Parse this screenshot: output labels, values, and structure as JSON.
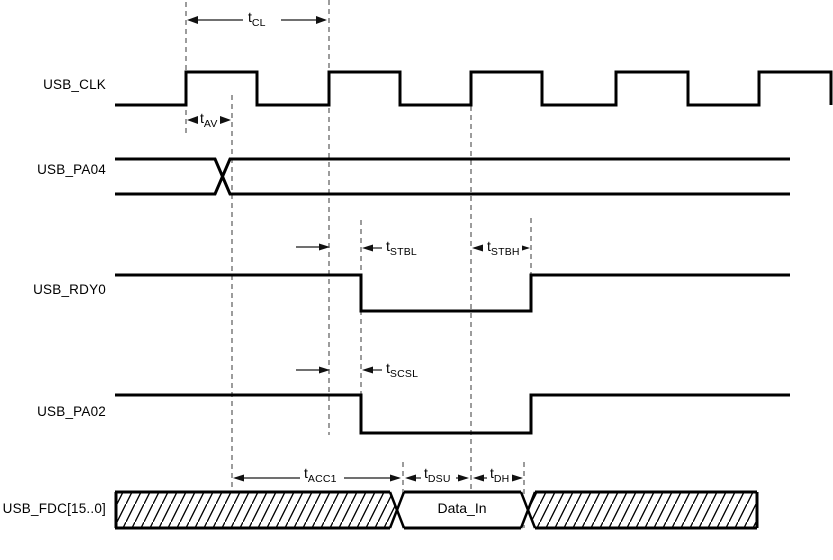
{
  "diagram": {
    "type": "timing-diagram",
    "background_color": "#ffffff",
    "signal_line_color": "#000000",
    "dashed_guide_color": "#5a5a5a",
    "dimension_line_color": "#1a1a1a",
    "signals": [
      {
        "label": "USB_CLK",
        "kind": "clock",
        "rising_edges_x": [
          186,
          329,
          471,
          616,
          759
        ],
        "falling_edges_x": [
          257,
          400,
          542,
          688,
          831
        ],
        "high_y": 72,
        "low_y": 105
      },
      {
        "label": "USB_PA04",
        "kind": "bus-cross",
        "change_x": 222,
        "top_y": 159,
        "bottom_y": 194
      },
      {
        "label": "USB_RDY0",
        "kind": "logic",
        "fall_x": 361,
        "rise_x": 531,
        "high_y": 275,
        "low_y": 311
      },
      {
        "label": "USB_PA02",
        "kind": "logic",
        "fall_x": 361,
        "rise_x": 531,
        "high_y": 395,
        "low_y": 433
      },
      {
        "label": "USB_FDC[15..0]",
        "kind": "bus",
        "valid_value": "Data_In",
        "valid_from_x": 397,
        "valid_to_x": 528,
        "top_y": 492,
        "bottom_y": 528
      }
    ],
    "timing_labels": [
      {
        "base": "t",
        "sub": "CL",
        "measures": "clock period (rising edge to rising edge)"
      },
      {
        "base": "t",
        "sub": "AV",
        "measures": "address valid after clock rise"
      },
      {
        "base": "t",
        "sub": "STBL",
        "measures": "strobe low delay from clock rise"
      },
      {
        "base": "t",
        "sub": "STBH",
        "measures": "strobe high delay from clock rise"
      },
      {
        "base": "t",
        "sub": "SCSL",
        "measures": "chip select low delay from clock rise"
      },
      {
        "base": "t",
        "sub": "ACC1",
        "measures": "access time"
      },
      {
        "base": "t",
        "sub": "DSU",
        "measures": "data setup time"
      },
      {
        "base": "t",
        "sub": "DH",
        "measures": "data hold time"
      }
    ],
    "bus_value": "Data_In"
  }
}
